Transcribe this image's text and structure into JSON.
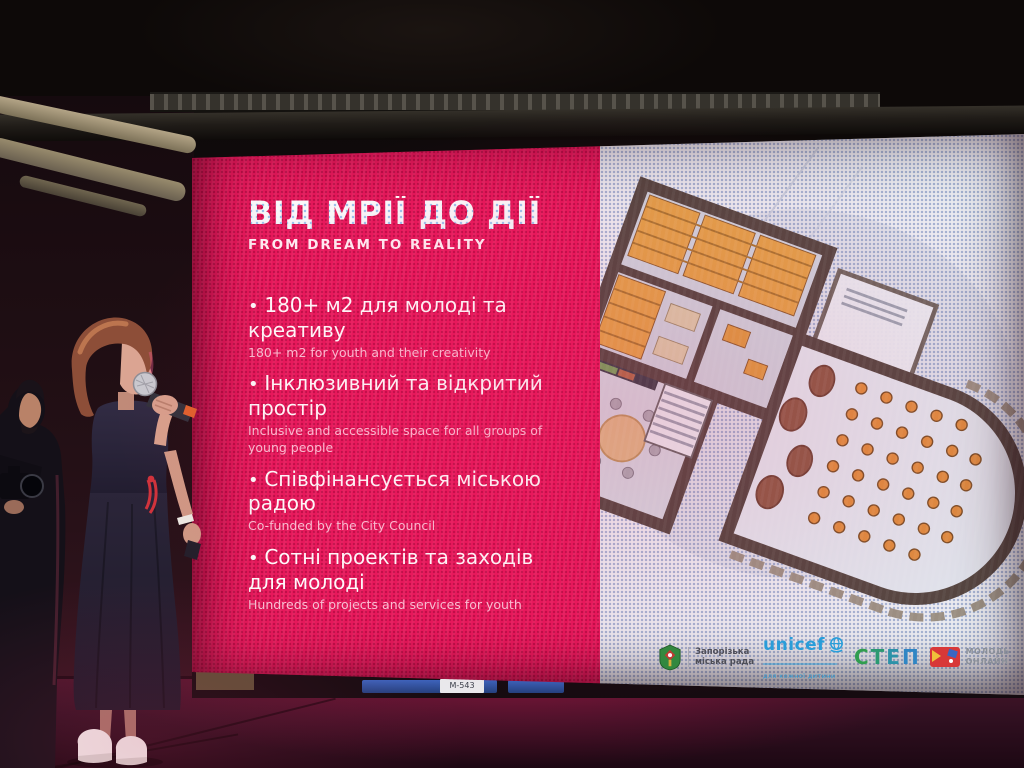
{
  "slide": {
    "title": "ВІД МРІЇ ДО ДІЇ",
    "subtitle": "FROM DREAM TO REALITY",
    "bullets": [
      {
        "uk": "180+ м2 для молоді та креативу",
        "en": "180+ m2 for youth and their creativity"
      },
      {
        "uk": "Інклюзивний та відкритий простір",
        "en": "Inclusive and accessible space for all groups of young people"
      },
      {
        "uk": "Співфінансується міською радою",
        "en": "Co-funded by the City Council"
      },
      {
        "uk": "Сотні проектів та заходів для молоді",
        "en": "Hundreds of projects and services for youth"
      }
    ],
    "logos": {
      "city": {
        "line1": "Запорізька",
        "line2": "міська рада"
      },
      "unicef": {
        "name": "unicef",
        "tagline": "для кожної дитини"
      },
      "step": {
        "letters": [
          "С",
          "Т",
          "Е",
          "П"
        ]
      },
      "youth": {
        "line1": "МОЛОДЬ",
        "line2": "ОНЛАЙН"
      }
    },
    "colors": {
      "panel_pink": "#e8195c",
      "panel_white": "#eceef3",
      "plan_wall": "#544741",
      "plan_furniture_orange": "#de8d3f",
      "unicef_blue": "#25a0dc",
      "step_green": "#2f9e4f",
      "youth_red": "#d83838"
    }
  },
  "stage": {
    "equipment_label": "M-543"
  }
}
